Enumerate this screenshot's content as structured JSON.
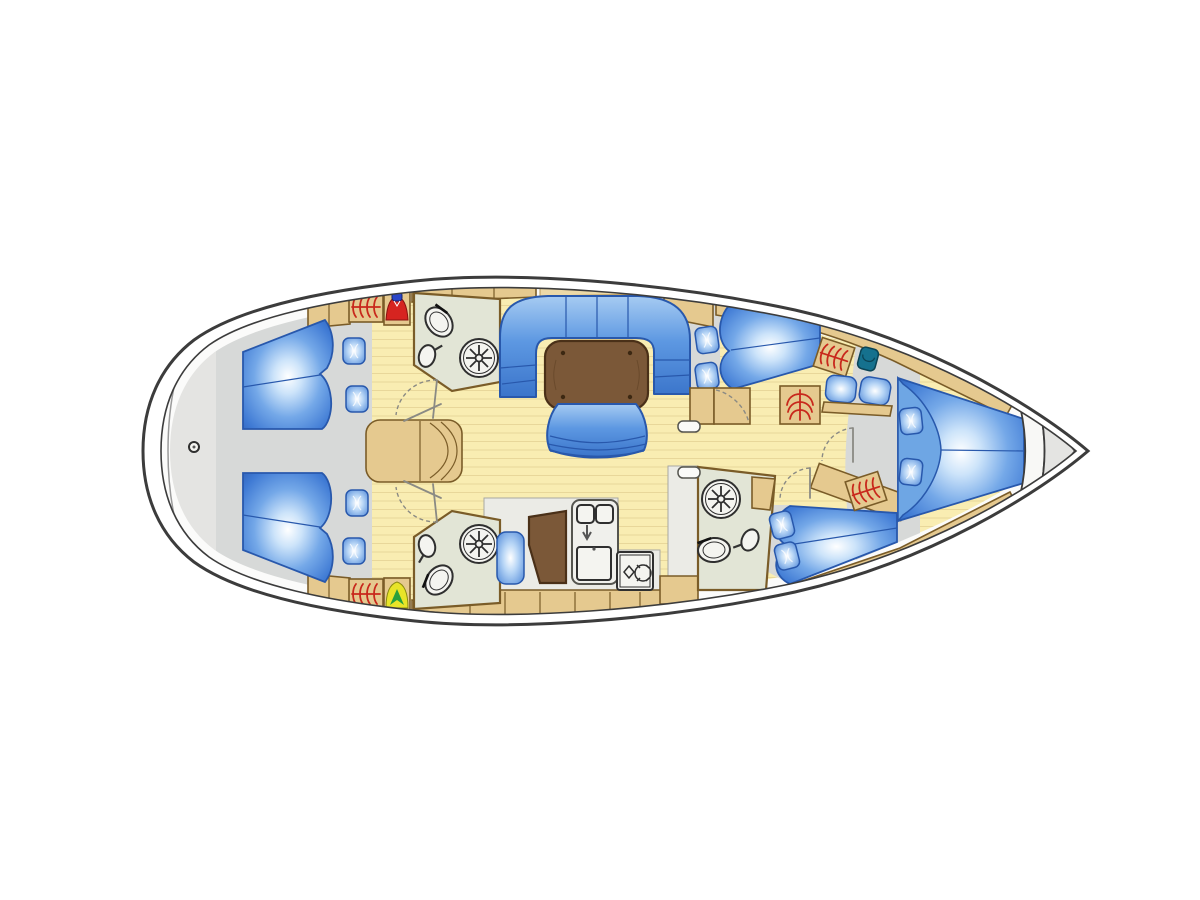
{
  "diagram": {
    "type": "sailing-yacht-interior-deck-plan",
    "view": "top-down",
    "orientation": "bow-right",
    "sections": [
      "swim-platform",
      "aft-cabin-port",
      "aft-cabin-starboard",
      "aft-head-port",
      "aft-head-starboard",
      "companionway-steps",
      "saloon",
      "galley",
      "nav-station",
      "mid-head",
      "guest-cabin-port",
      "guest-cabin-starboard",
      "forward-v-berth",
      "anchor-locker"
    ],
    "fixture_counts": {
      "double_berths": 5,
      "showers": 3,
      "toilets": 3,
      "wash_basins": 3,
      "galley_sink_bowls": 2,
      "galley_burners": 2,
      "hanging_locker_symbols": 5,
      "wet_locker_jackets": 2,
      "loose_cushions": 8,
      "seat_cushions": 2
    }
  },
  "colors": {
    "background": "#ffffff",
    "hull_fill": "#ffffff",
    "hull_outline": "#3c3c3c",
    "deck": "#e4e4e2",
    "deck_line": "#9a9a9a",
    "floor_wood": "#f9edb2",
    "floor_stripe": "#e8d79a",
    "cabin_sole": "#d7d9d8",
    "pale_floor": "#ebebe6",
    "cabinetry_tan": "#e5c98f",
    "cabinetry_light": "#ecd9a8",
    "cabinetry_outline": "#7a5c28",
    "bath_floor": "#e2e5d6",
    "upholstery_blue": "#5d98e2",
    "upholstery_deep": "#2b5cb4",
    "upholstery_light": "#cde4fa",
    "upholstery_outline": "#2858ac",
    "pillow_zone": "#6ea6e4",
    "table_brown": "#7b5838",
    "table_outline": "#4a3018",
    "counter": "#f0f0ec",
    "fixture_fill": "#f4f4f0",
    "fixture_outline": "#2f2f2f",
    "hanger_red": "#c8281c",
    "jacket_red": "#d62420",
    "jacket_hood_blue": "#2b46c8",
    "jacket_yellow": "#e8e428",
    "jacket_chevron_green": "#28a03c",
    "seat_teal": "#15718e"
  }
}
